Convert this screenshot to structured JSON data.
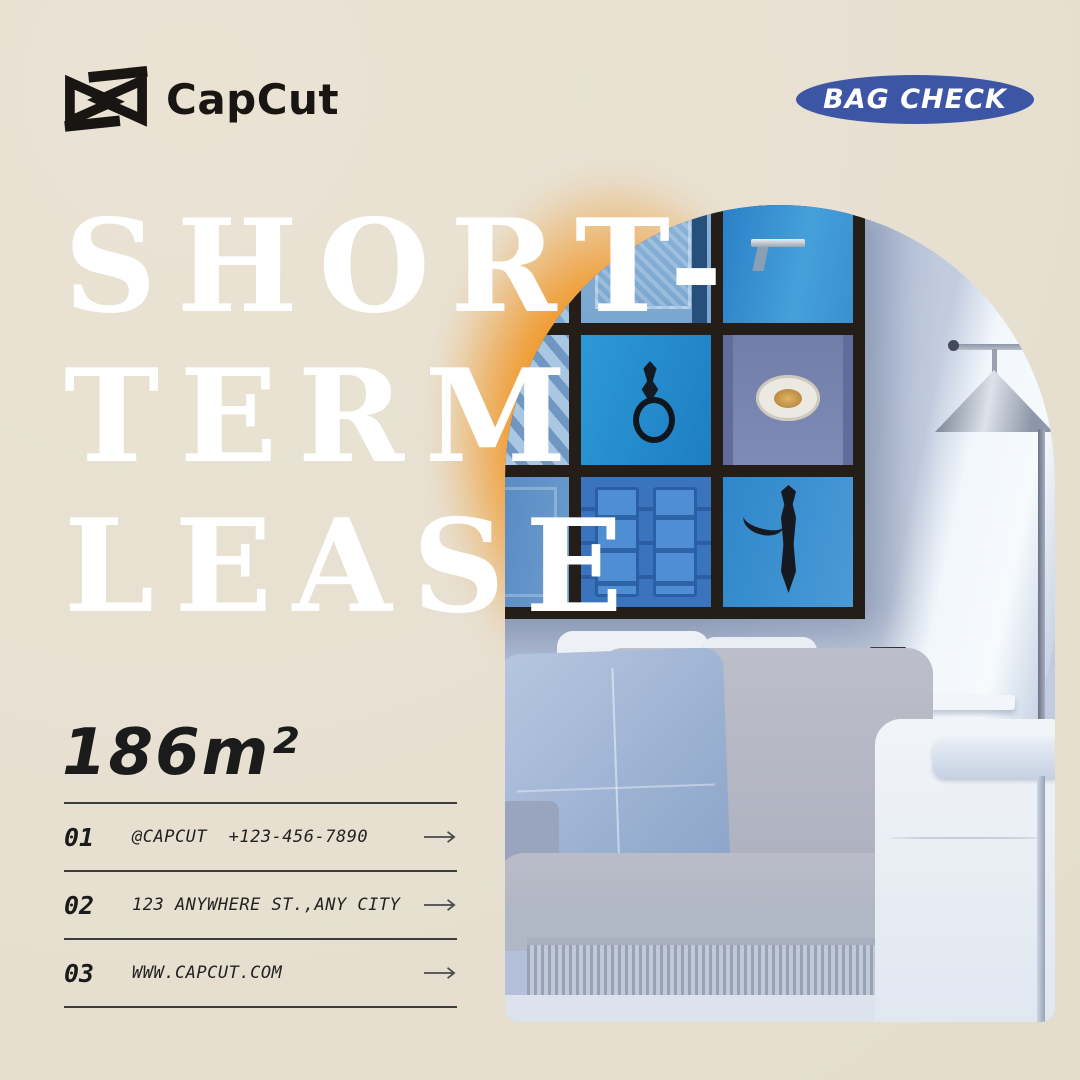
{
  "page": {
    "background": "#e8e1d1"
  },
  "brand": {
    "name": "CapCut",
    "color": "#181512"
  },
  "badge": {
    "label": "BAG CHECK",
    "background": "#3c56a5",
    "text_color": "#ffffff"
  },
  "title": {
    "lines": [
      "SHORT-",
      "TERM",
      "LEASE"
    ],
    "color": "#ffffff"
  },
  "area": {
    "value": "186m²"
  },
  "contacts": {
    "rows": [
      {
        "number": "01",
        "text": "@CAPCUT  +123-456-7890"
      },
      {
        "number": "02",
        "text": "123 ANYWHERE ST.,ANY CITY"
      },
      {
        "number": "03",
        "text": "WWW.CAPCUT.COM"
      }
    ]
  },
  "accents": {
    "glow_orange": "#f0982a",
    "door_frame": "#251e18",
    "line_color": "#3c3c3c",
    "arrow_color": "#4a4a4a"
  }
}
